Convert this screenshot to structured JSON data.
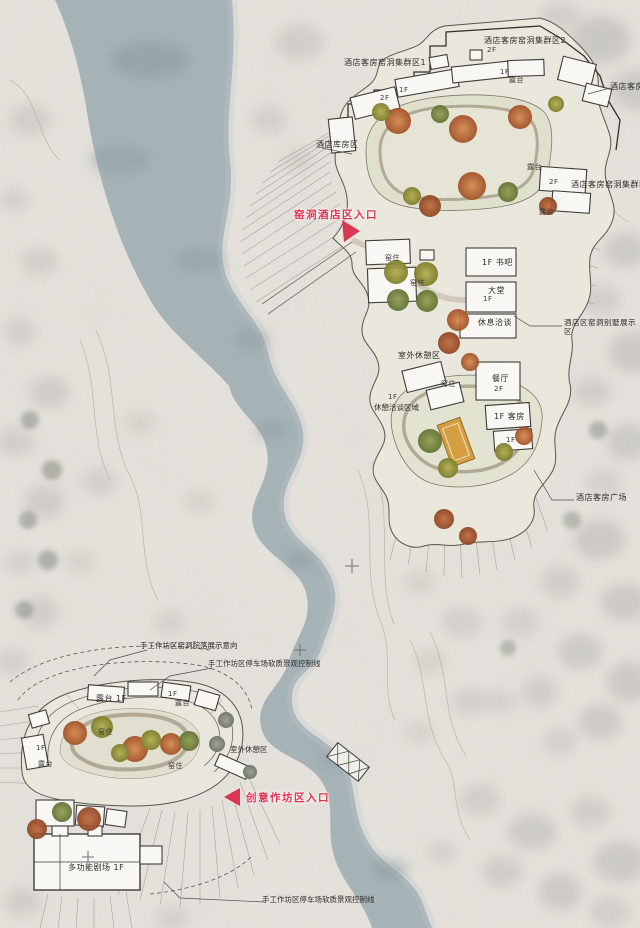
{
  "plan": {
    "type": "landscape-architecture master plan",
    "zones": [
      "窑洞酒店区",
      "创意作坊区"
    ]
  },
  "entrances": {
    "hotel": "窑洞酒店区入口",
    "workshop": "创意作坊区入口"
  },
  "labels": {
    "hotel_cluster_1": "酒店客房窑洞集群区1",
    "hotel_cluster_2": "酒店客房窑洞集群区2",
    "hotel_cluster_3": "酒店客房窑洞集群区3",
    "hotel_partial": "酒店客房",
    "hotel_storage": "酒店库房区",
    "terrace": "露台",
    "terrace_1f": "露台 1F",
    "floor_1f": "1F",
    "floor_2f": "2F",
    "yaozhu": "窑住",
    "book_bar": "1F 书吧",
    "lobby": "大堂",
    "lounge": "休息洽谈",
    "villa_display": "酒店区窑洞别墅展示区",
    "outdoor_rest": "室外休憩区",
    "rest_talk": "休憩洽谈区域",
    "restaurant": "餐厅",
    "guestroom": "1F 客房",
    "hotel_plaza": "酒店客房广场",
    "theater": "多功能剧场 1F",
    "workshop_display_line": "手工作坊区窑洞院落展示意向",
    "workshop_control_line": "手工作坊区停车场软质景观控制线"
  },
  "colors": {
    "paper": "#e9e6e0",
    "river": "#a8b5b9",
    "site_ground": "#edebdf",
    "courtyard": "#e2e4cf",
    "building": "#fcfbf8",
    "outline": "#3c3a36",
    "tree_orange": "#b86234",
    "tree_olive": "#9a9a3c",
    "tree_green": "#6f8040",
    "accent_red": "#e03352",
    "pool_amber": "#d7a03f"
  }
}
